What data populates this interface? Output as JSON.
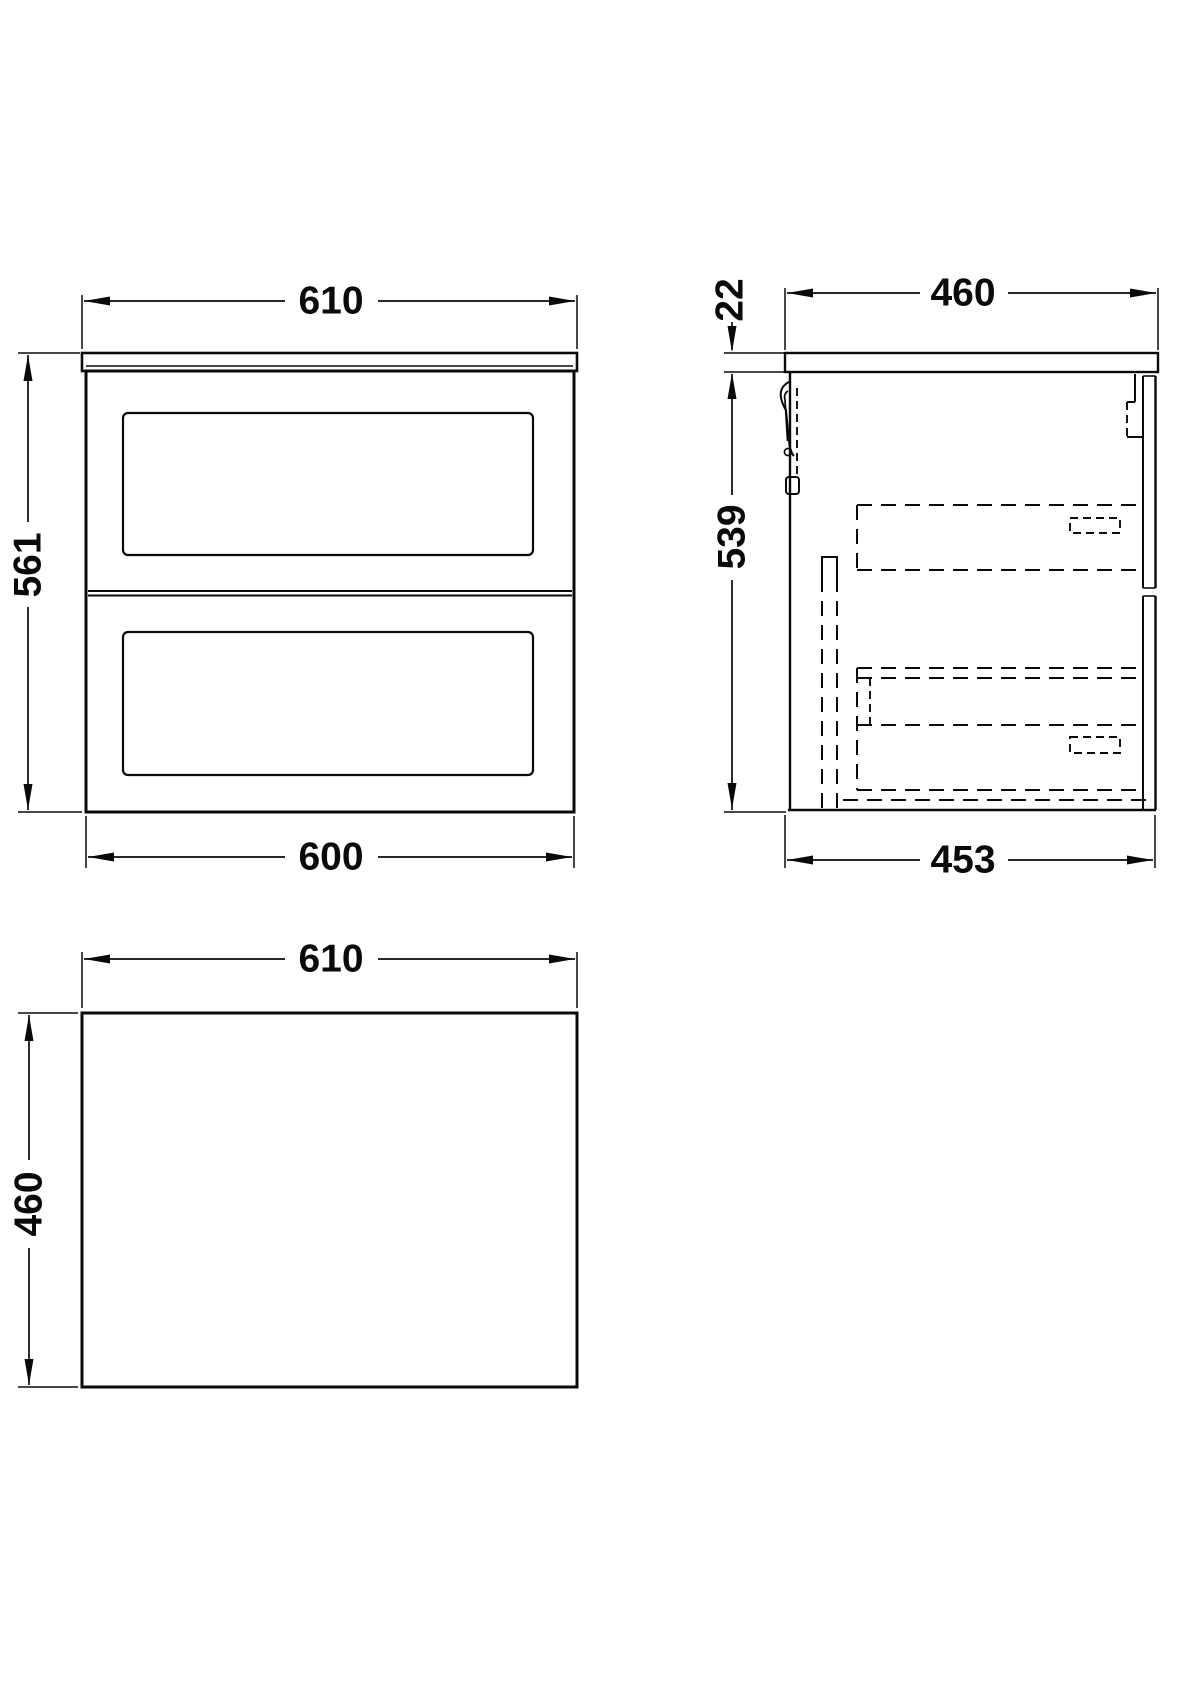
{
  "drawing": {
    "type": "technical-orthographic-drawing",
    "subject": "wall-hung two-drawer vanity unit",
    "unit": "mm",
    "line_color": "#0a0a0a",
    "background_color": "#ffffff"
  },
  "views": {
    "front": {
      "label": "front-elevation",
      "dim_width_top_mm": "610",
      "dim_height_mm": "561",
      "dim_width_bottom_mm": "600"
    },
    "side": {
      "label": "side-section",
      "dim_depth_top_mm": "460",
      "dim_worktop_thickness_mm": "22",
      "dim_body_height_mm": "539",
      "dim_depth_bottom_mm": "453"
    },
    "plan": {
      "label": "plan-view",
      "dim_width_mm": "610",
      "dim_depth_mm": "460"
    }
  }
}
